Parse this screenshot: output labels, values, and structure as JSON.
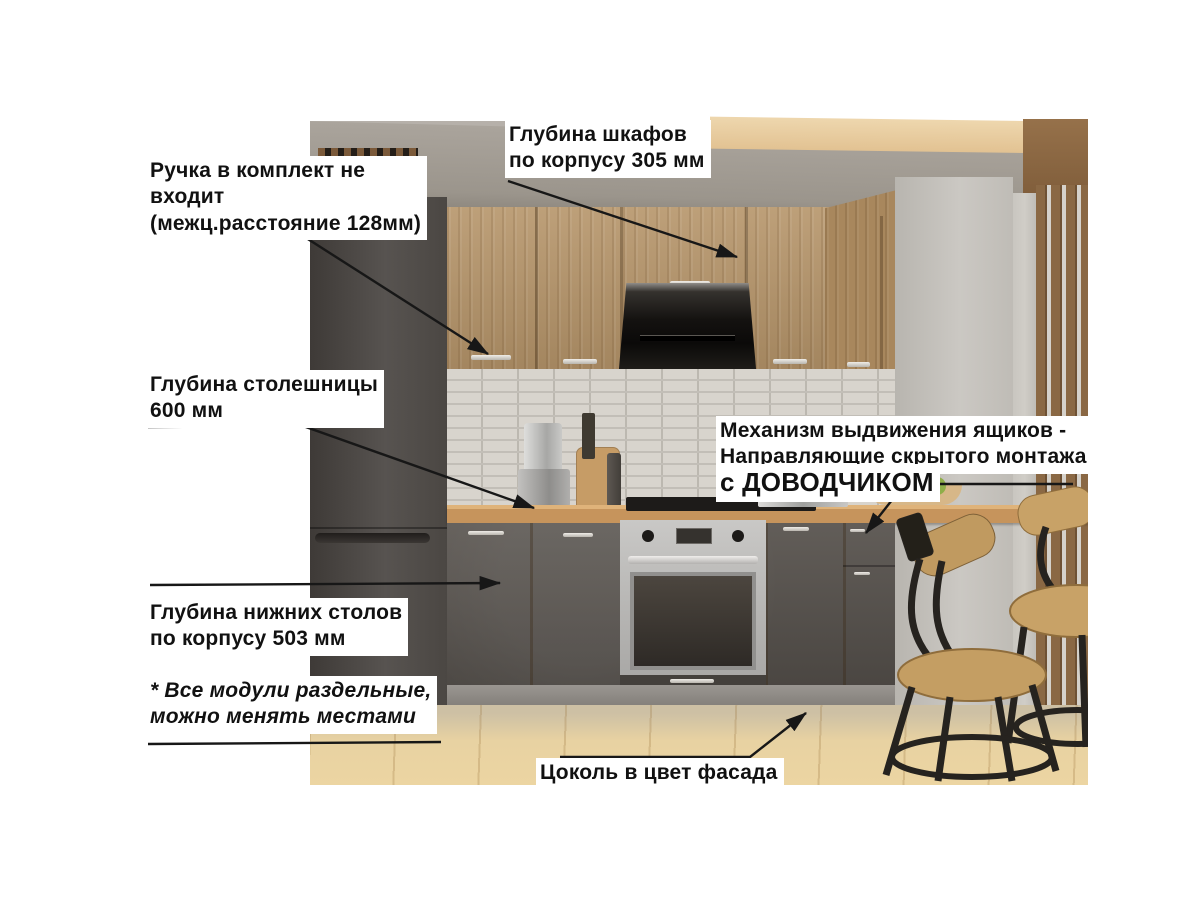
{
  "annotations": {
    "cabinet_depth": "Глубина шкафов\n по корпусу 305 мм",
    "handle_note": "Ручка в комплект не\nвходит\n(межц.расстояние 128мм)",
    "countertop_depth": "Глубина столешницы\n 600 мм",
    "drawer_mechanism": "Механизм выдвижения ящиков -\nНаправляющие скрытого монтажа",
    "soft_close": "с ДОВОДЧИКОМ",
    "base_depth": "Глубина нижних столов\nпо корпусу 503 мм",
    "modules_note": "* Все модули раздельные,\nможно менять местами",
    "plinth_note": "Цоколь в цвет фасада"
  },
  "palette": {
    "background": "#ffffff",
    "annotation_text": "#111111",
    "annotation_line": "#171717",
    "label_background": "#ffffff",
    "cabinet_wood": "#b6956a",
    "base_cabinet": "#56514c",
    "countertop": "#c6945c",
    "backsplash": "#d8d4cd",
    "fridge": "#4b4743",
    "floor": "#e8d2a2",
    "wall": "#b2ada6",
    "ceiling": "#9b958c",
    "slat_wood": "#8a6844",
    "stool_wood": "#c49e63",
    "stool_metal": "#26231f",
    "oven_steel": "#b3b2b0",
    "hood_black": "#141210",
    "side_panel": "#c6c3be"
  }
}
